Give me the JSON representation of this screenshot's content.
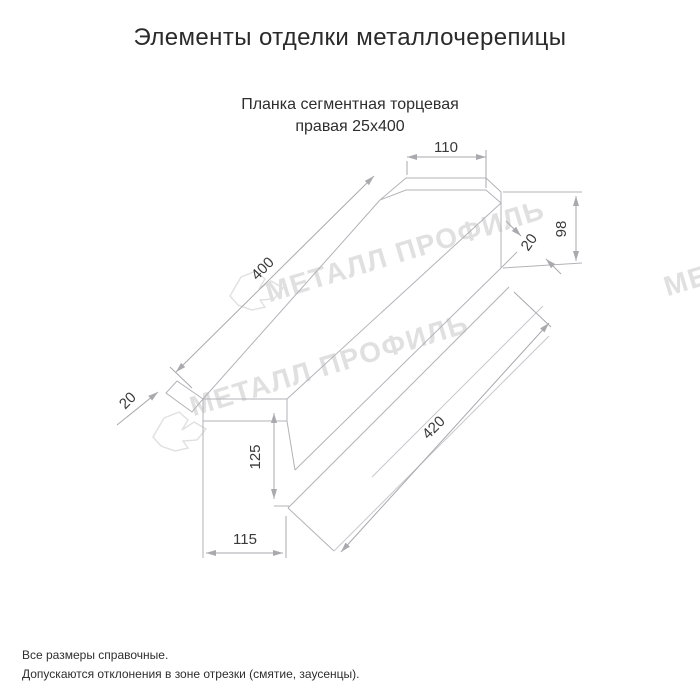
{
  "title": "Элементы отделки металлочерепицы",
  "subtitle": {
    "line1": "Планка сегментная торцевая",
    "line2": "правая 25х400"
  },
  "watermark_text": "МЕТАЛЛ ПРОФИЛЬ",
  "dims": {
    "top_flange_width": "110",
    "top_length": "400",
    "end_height": "98",
    "fold_right": "20",
    "bottom_length": "420",
    "web_height": "125",
    "bottom_flange_width": "115",
    "fold_left": "20"
  },
  "footer": {
    "line1": "Все размеры справочные.",
    "line2": "Допускаются отклонения в зоне отрезки (смятие, заусенцы)."
  },
  "colors": {
    "background": "#ffffff",
    "line": "#b3b3b8",
    "line_faint": "#c9c9cd",
    "dim": "#a9a9ae",
    "dim_text": "#3a3a3a",
    "watermark": "#e0e0e0",
    "title_text": "#2a2a2a",
    "body_text": "#2e2e2e"
  }
}
